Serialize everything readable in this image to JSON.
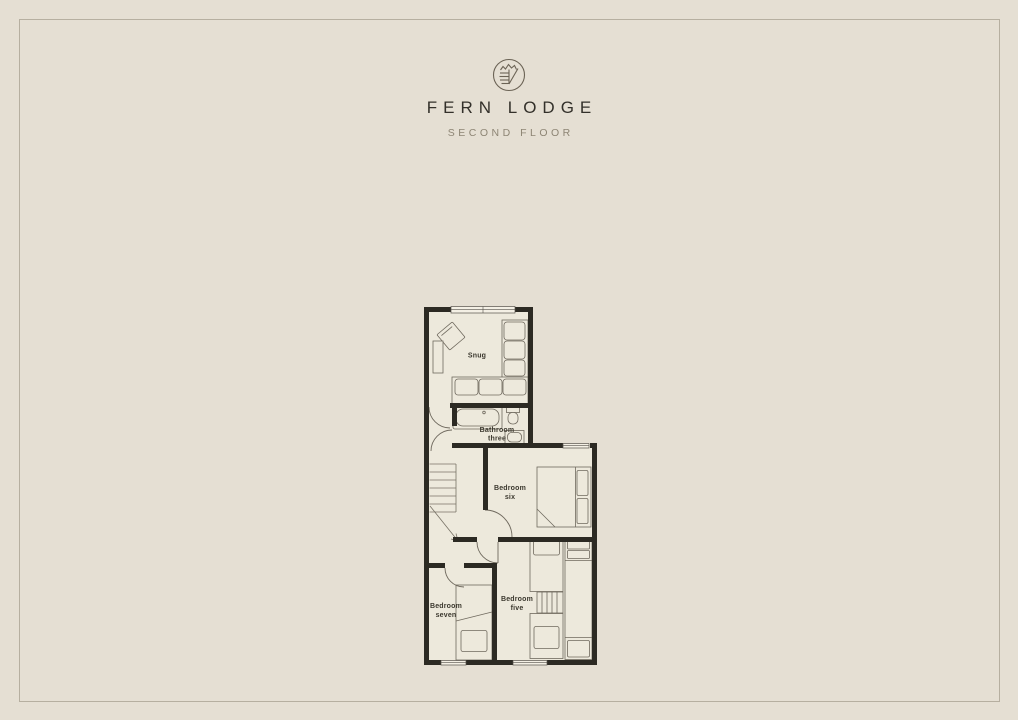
{
  "page": {
    "title": "FERN LODGE",
    "subtitle": "SECOND FLOOR",
    "colors": {
      "background": "#e5dfd3",
      "frame_border": "#b6afa0",
      "wall": "#2c2a23",
      "plan_interior": "#ede9dc",
      "furniture_line": "#6f695e",
      "title_text": "#33302a",
      "subtitle_text": "#8d8574",
      "room_label_text": "#3b382e"
    }
  },
  "floorplan": {
    "rooms": {
      "snug": {
        "line1": "Snug",
        "line2": ""
      },
      "bathroom_three": {
        "line1": "Bathroom",
        "line2": "three"
      },
      "bedroom_six": {
        "line1": "Bedroom",
        "line2": "six"
      },
      "bedroom_seven": {
        "line1": "Bedroom",
        "line2": "seven"
      },
      "bedroom_five": {
        "line1": "Bedroom",
        "line2": "five"
      }
    }
  }
}
